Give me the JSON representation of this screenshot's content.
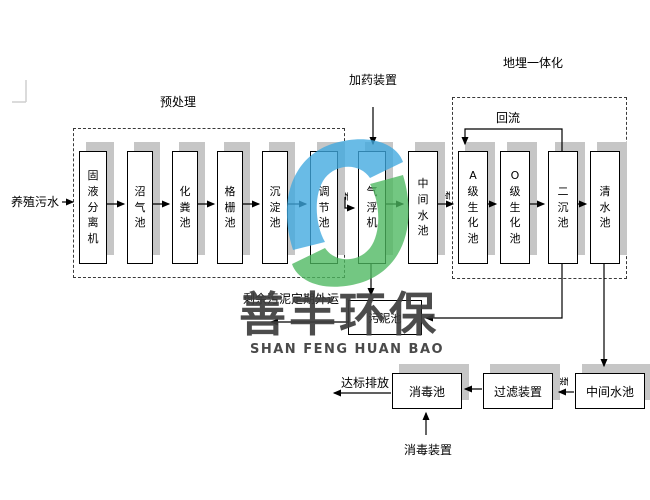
{
  "labels": {
    "input": "养殖污水",
    "pretreatment_group": "预处理",
    "integrated_group": "地埋一体化",
    "reflux": "回流",
    "dosing_device": "加药装置",
    "pump": "泵",
    "sludge_note": "剩余污泥定期外运",
    "discharge": "达标排放",
    "disinfection_device": "消毒装置"
  },
  "top_row": [
    "固液分离机",
    "沼气池",
    "化粪池",
    "格栅池",
    "沉淀池",
    "调节池",
    "气浮机",
    "中间水池",
    "A级生化池",
    "O级生化池",
    "二沉池",
    "清水池"
  ],
  "sludge_box": "污泥池",
  "bottom_row": [
    "消毒池",
    "过滤装置",
    "中间水池"
  ],
  "watermark": {
    "cn": "善丰环保",
    "en": "SHAN FENG HUAN BAO",
    "logo_blue": "#3fa9e0",
    "logo_green": "#4db85f"
  }
}
